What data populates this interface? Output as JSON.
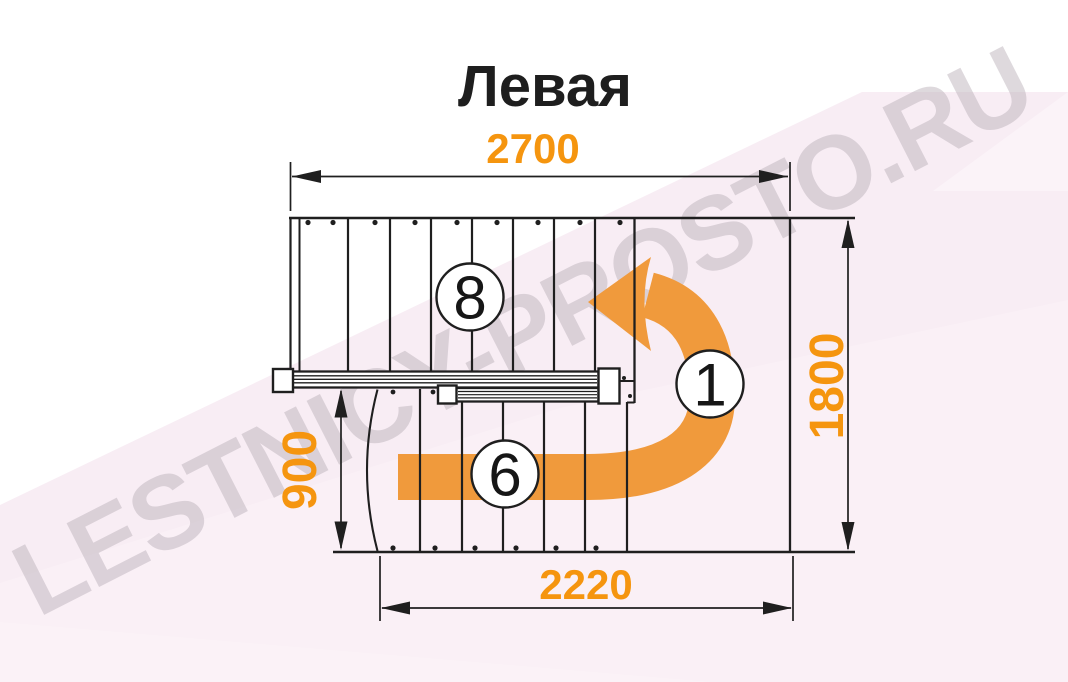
{
  "title": "Левая",
  "watermark": "LESTNICY-PROSTO.RU",
  "diagram": {
    "dimensions": {
      "top_width": "2700",
      "right_height": "1800",
      "left_flight_height": "900",
      "bottom_width": "2220"
    },
    "step_markers": {
      "upper_flight": "8",
      "landing": "1",
      "lower_flight": "6"
    }
  },
  "colors": {
    "dimension-text": "#F5950F",
    "arrow": "#F09A3C",
    "line": "#1F1F1F",
    "watermark": "#B7ADB6",
    "background-tint": "#F8EDF4"
  }
}
